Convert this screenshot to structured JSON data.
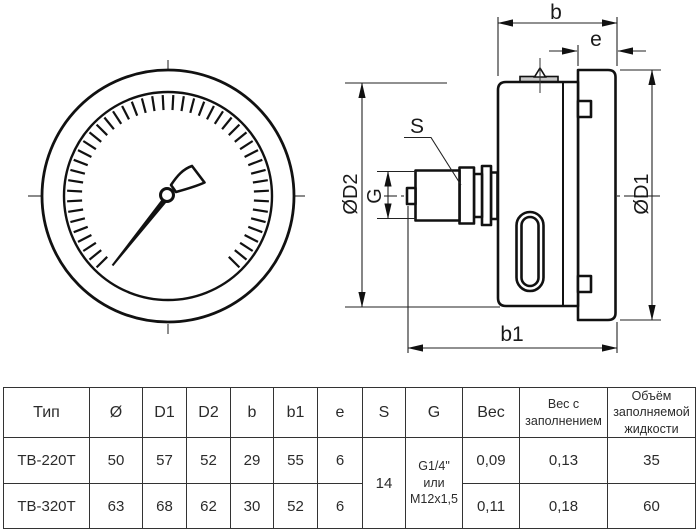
{
  "drawing": {
    "dim_labels": {
      "b": "b",
      "e": "e",
      "od1": "ØD1",
      "od2": "ØD2",
      "g": "G",
      "s": "S",
      "b1": "b1"
    }
  },
  "table": {
    "headers": [
      "Тип",
      "Ø",
      "D1",
      "D2",
      "b",
      "b1",
      "e",
      "S",
      "G",
      "Вес",
      "Вес с заполнением",
      "Объём заполняемой жидкости"
    ],
    "shared": {
      "s": "14",
      "g": "G1/4\"\nили\nM12x1,5"
    },
    "rows": [
      {
        "type": "ТВ-220Т",
        "diameter": "50",
        "d1": "57",
        "d2": "52",
        "b": "29",
        "b1": "55",
        "e": "6",
        "weight": "0,09",
        "weight_filled": "0,13",
        "fill_volume": "35"
      },
      {
        "type": "ТВ-320Т",
        "diameter": "63",
        "d1": "68",
        "d2": "62",
        "b": "30",
        "b1": "52",
        "e": "6",
        "weight": "0,11",
        "weight_filled": "0,18",
        "fill_volume": "60"
      }
    ]
  }
}
